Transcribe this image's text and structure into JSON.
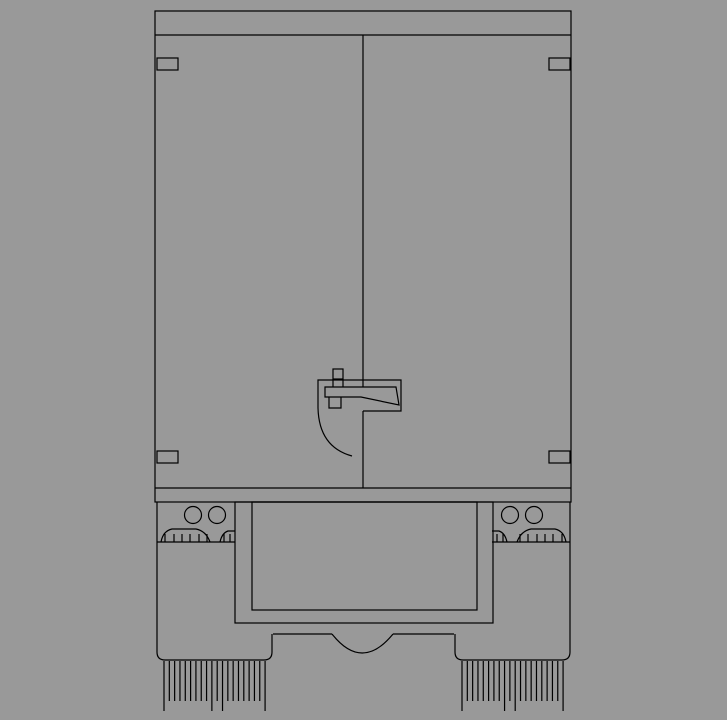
{
  "canvas": {
    "width": 727,
    "height": 720,
    "background_color": "#999999",
    "line_color": "#000000",
    "line_width": 1.2
  },
  "drawing": {
    "subject": "truck-rear-elevation-cad-drawing",
    "elements": [
      {
        "name": "cargo-box-outline",
        "type": "rect",
        "x": 155,
        "y": 11,
        "w": 416,
        "h": 491
      },
      {
        "name": "roof-rail-line",
        "type": "line",
        "x1": 155,
        "y1": 35,
        "x2": 571,
        "y2": 35
      },
      {
        "name": "bumper-top-line",
        "type": "line",
        "x1": 155,
        "y1": 488,
        "x2": 571,
        "y2": 488
      },
      {
        "name": "door-split-line-upper",
        "type": "line",
        "x1": 363,
        "y1": 35,
        "x2": 363,
        "y2": 387
      },
      {
        "name": "door-split-line-lower",
        "type": "line",
        "x1": 363,
        "y1": 411,
        "x2": 363,
        "y2": 488
      },
      {
        "name": "hinge-top-left",
        "type": "rect",
        "x": 157,
        "y": 58,
        "w": 21,
        "h": 12
      },
      {
        "name": "hinge-top-right",
        "type": "rect",
        "x": 549,
        "y": 58,
        "w": 21,
        "h": 12
      },
      {
        "name": "hinge-bottom-left",
        "type": "rect",
        "x": 157,
        "y": 451,
        "w": 21,
        "h": 12
      },
      {
        "name": "hinge-bottom-right",
        "type": "rect",
        "x": 549,
        "y": 451,
        "w": 21,
        "h": 12
      },
      {
        "name": "handle-knob",
        "type": "rect",
        "x": 333,
        "y": 369,
        "w": 10,
        "h": 10
      },
      {
        "name": "handle-shaft-upper-left",
        "type": "line",
        "x1": 333,
        "y1": 379,
        "x2": 333,
        "y2": 387
      },
      {
        "name": "handle-shaft-upper-right",
        "type": "line",
        "x1": 343,
        "y1": 379,
        "x2": 343,
        "y2": 387
      },
      {
        "name": "handle-shaft-lower",
        "type": "path",
        "d": "M329,397 L329,408 L341,408 L341,397"
      },
      {
        "name": "handle-housing",
        "type": "path",
        "d": "M318,408 L318,380 L401,380 L401,411 L363,411"
      },
      {
        "name": "handle-bar",
        "type": "path",
        "d": "M325,397 L325,387 L396,387 L399,405 L361,397 Z"
      },
      {
        "name": "door-swing-arc",
        "type": "path",
        "d": "M318,408 Q319,447 352,456"
      },
      {
        "name": "frame-outer-rect",
        "type": "rect",
        "x": 235,
        "y": 502,
        "w": 258,
        "h": 121
      },
      {
        "name": "frame-inner-rect",
        "type": "rect",
        "x": 252,
        "y": 502,
        "w": 225,
        "h": 108
      },
      {
        "name": "axle-line-left",
        "type": "line",
        "x1": 273,
        "y1": 634,
        "x2": 332,
        "y2": 634
      },
      {
        "name": "axle-line-right",
        "type": "line",
        "x1": 393,
        "y1": 634,
        "x2": 454,
        "y2": 634
      },
      {
        "name": "differential-arc",
        "type": "path",
        "d": "M332,634 Q362,672 393,634"
      },
      {
        "name": "mudflap-left-outline",
        "type": "path",
        "d": "M157,502 L157,652 Q157,660 165,660 L264,660 Q272,660 272,652 L272,634"
      },
      {
        "name": "mudflap-left-top-edge",
        "type": "line",
        "x1": 157,
        "y1": 542,
        "x2": 235,
        "y2": 542
      },
      {
        "name": "mudflap-right-outline",
        "type": "path",
        "d": "M570,502 L570,652 Q570,660 562,660 L463,660 Q455,660 455,652 L455,634"
      },
      {
        "name": "mudflap-right-top-edge",
        "type": "line",
        "x1": 492,
        "y1": 542,
        "x2": 570,
        "y2": 542
      },
      {
        "name": "marker-light-left-outer",
        "type": "circle",
        "cx": 193,
        "cy": 515,
        "r": 8.5
      },
      {
        "name": "marker-light-left-inner",
        "type": "circle",
        "cx": 217,
        "cy": 515,
        "r": 8.5
      },
      {
        "name": "marker-light-right-inner",
        "type": "circle",
        "cx": 510,
        "cy": 515,
        "r": 8.5
      },
      {
        "name": "marker-light-right-outer",
        "type": "circle",
        "cx": 534,
        "cy": 515,
        "r": 8.5
      },
      {
        "name": "tire-left-outer",
        "type": "path",
        "d": "M161,542 Q163,531 172,529 L196,529 Q206,531 210,542"
      },
      {
        "name": "tire-left-inner",
        "type": "path",
        "d": "M220,542 Q222,533 228,531 L235,531"
      },
      {
        "name": "tire-right-outer",
        "type": "path",
        "d": "M566,542 Q564,531 555,529 L531,529 Q521,531 517,542"
      },
      {
        "name": "tire-right-inner",
        "type": "path",
        "d": "M507,542 Q505,533 499,531 L492,531"
      },
      {
        "name": "tread-ticks-left-outer",
        "type": "vlines",
        "xs": [
          165,
          174,
          182,
          190,
          199,
          207
        ],
        "y1": 534,
        "y2": 542
      },
      {
        "name": "tread-ticks-left-inner",
        "type": "vlines",
        "xs": [
          224,
          230
        ],
        "y1": 534,
        "y2": 542
      },
      {
        "name": "tread-ticks-right-outer",
        "type": "vlines",
        "xs": [
          520,
          528,
          537,
          545,
          553,
          562
        ],
        "y1": 534,
        "y2": 542
      },
      {
        "name": "tread-ticks-right-inner",
        "type": "vlines",
        "xs": [
          497,
          503
        ],
        "y1": 534,
        "y2": 542
      },
      {
        "name": "mudflap-fringe-left",
        "type": "fringe",
        "x0": 164,
        "dx": 5.32,
        "count": 20,
        "y1": 661,
        "y2_short": 701,
        "y2_long": 711,
        "long_indices": [
          0,
          9,
          11,
          19
        ]
      },
      {
        "name": "mudflap-fringe-right",
        "type": "fringe",
        "x0": 462,
        "dx": 5.32,
        "count": 20,
        "y1": 661,
        "y2_short": 701,
        "y2_long": 711,
        "long_indices": [
          0,
          8,
          10,
          19
        ]
      }
    ]
  }
}
